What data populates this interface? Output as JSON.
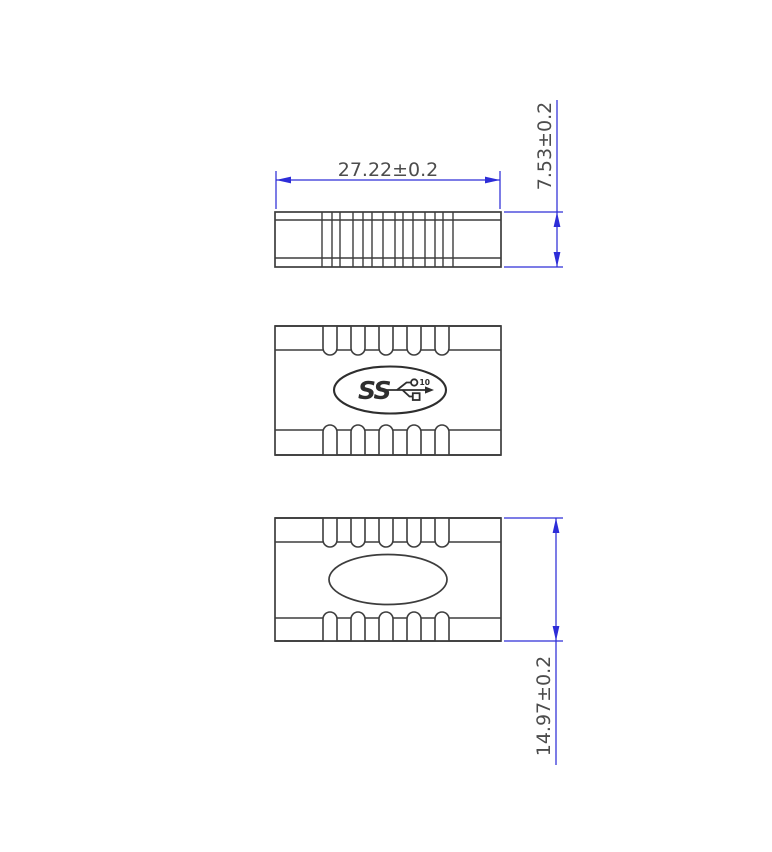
{
  "drawing": {
    "background": "#ffffff",
    "colors": {
      "outline": "#3d3d3d",
      "dimension_line": "#2d2dd8",
      "dimension_text": "#4c4c4c",
      "logo": "#2e2e2e",
      "background": "#ffffff"
    },
    "dimensions": {
      "overall_width": "27.22±0.2",
      "side_height": "7.53±0.2",
      "body_height": "14.97±0.2"
    },
    "logo": {
      "icon": "usb-superspeed-10-logo",
      "ss_text": "SS",
      "speed_text": "10"
    }
  }
}
